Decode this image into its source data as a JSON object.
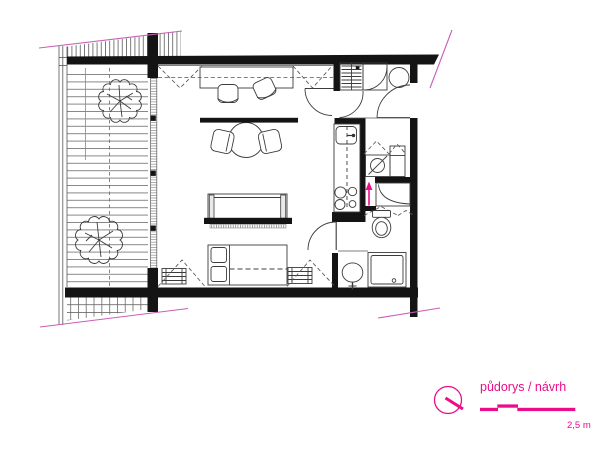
{
  "legend": {
    "title": "půdorys / návrh",
    "scale_label": "2,5 m"
  },
  "colors": {
    "accent_magenta": "#e90d8c",
    "boundary_magenta": "#c95fb6",
    "wall_black": "#141414",
    "line_gray": "#3c3c3c"
  },
  "symbols": [
    "tree-icon",
    "dining-table-icon",
    "dining-chair-icon",
    "desk-icon",
    "desk-chair-icon",
    "sofa-icon",
    "bed-icon",
    "radiator-icon",
    "kitchen-sink-icon",
    "stove-icon",
    "washing-machine-icon",
    "toilet-icon",
    "washbasin-icon",
    "shower-icon",
    "wardrobe-icon",
    "corner-shelf-icon",
    "boiler-icon",
    "door-swing-icon",
    "window-symbol-icon",
    "compass-icon",
    "entry-arrow-icon",
    "scale-bar"
  ]
}
